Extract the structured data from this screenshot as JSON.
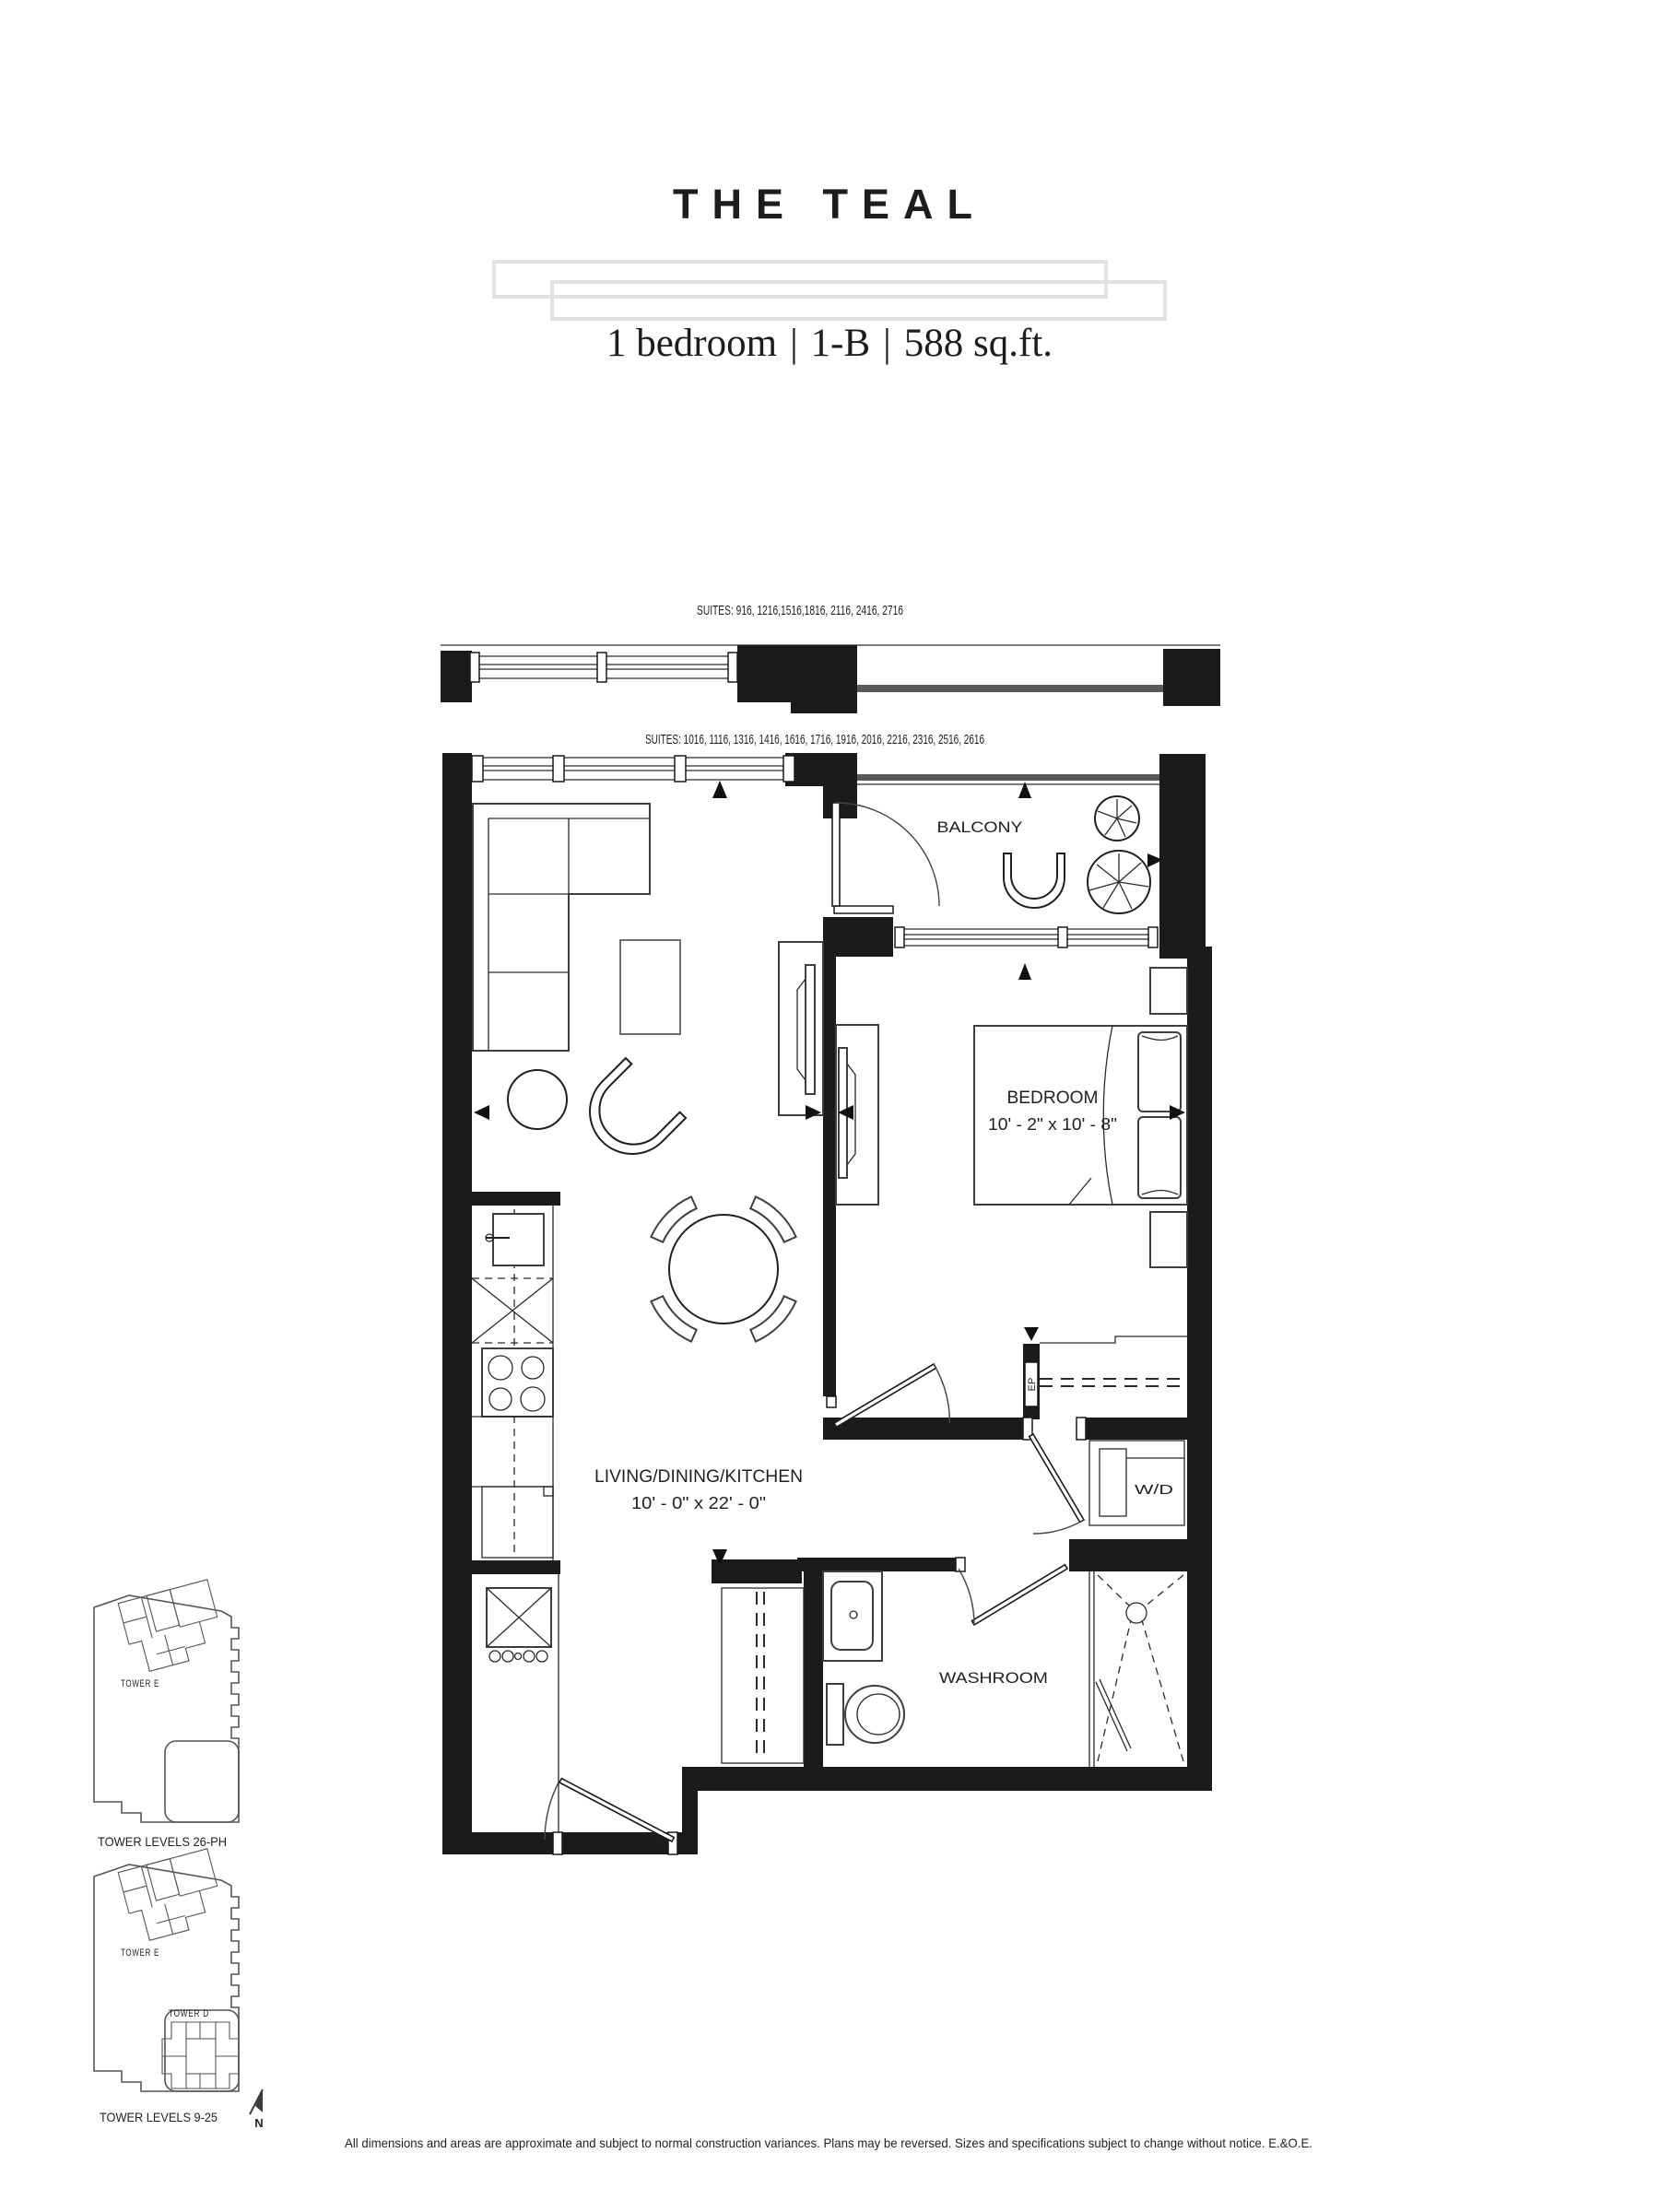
{
  "header": {
    "title": "THE TEAL",
    "subtitle": {
      "bedrooms": "1 bedroom",
      "plan_code": "1-B",
      "area": "588 sq.ft.",
      "separator": "|"
    }
  },
  "plan": {
    "suites_note_upper": "SUITES: 916, 1216,1516,1816, 2116, 2416, 2716",
    "suites_note_main": "SUITES: 1016, 1116, 1316, 1416, 1616, 1716, 1916, 2016, 2216, 2316, 2516, 2616",
    "rooms": {
      "balcony": {
        "label": "BALCONY"
      },
      "bedroom": {
        "label": "BEDROOM",
        "dims": "10' - 2\" x 10' - 8\""
      },
      "living": {
        "label": "LIVING/DINING/KITCHEN",
        "dims": "10' - 0\" x 22' - 0\""
      },
      "washroom": {
        "label": "WASHROOM"
      },
      "laundry": {
        "label": "W/D"
      },
      "electrical_panel": {
        "label": "EP"
      }
    }
  },
  "keyplans": {
    "upper": {
      "caption": "TOWER LEVELS 26-PH",
      "tower_e_label": "TOWER E"
    },
    "lower": {
      "caption": "TOWER LEVELS 9-25",
      "tower_e_label": "TOWER E",
      "tower_d_label": "TOWER D"
    },
    "north_label": "N",
    "highlight_color": "#b9b9ba"
  },
  "footer": {
    "disclaimer": "All dimensions and areas are approximate and subject to normal construction variances. Plans may be reversed. Sizes and specifications subject to change without notice. E.&O.E."
  },
  "colors": {
    "ink": "#231f20",
    "wall": "#1b1b1b",
    "railing": "#58595b",
    "deco_bar": "#e2e2e3"
  }
}
